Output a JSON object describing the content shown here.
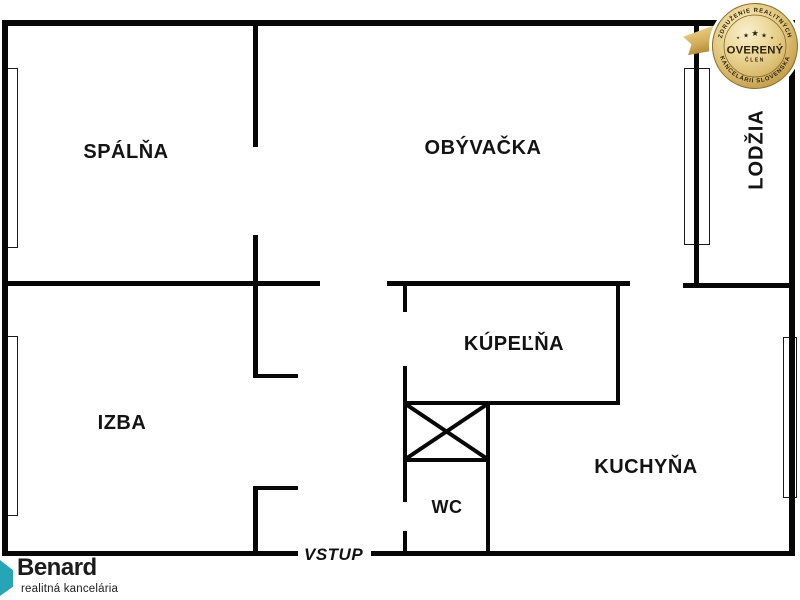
{
  "plan": {
    "background": "#ffffff",
    "wall_color": "#000000",
    "rooms": {
      "spalna": {
        "label": "SPÁLŇA"
      },
      "obyvacka": {
        "label": "OBÝVAČKA"
      },
      "lodzia": {
        "label": "LODŽIA"
      },
      "izba": {
        "label": "IZBA"
      },
      "kupelna": {
        "label": "KÚPEĽŇA"
      },
      "wc": {
        "label": "WC"
      },
      "kuchyna": {
        "label": "KUCHYŇA"
      }
    },
    "entrance_label": "VSTUP"
  },
  "badge": {
    "arc_top": "ZDRUŽENIE REALITNÝCH",
    "arc_bottom": "KANCELÁRIÍ SLOVENSKA",
    "title": "OVERENÝ",
    "subtitle": "ČLEN",
    "stars": {
      "s1": "★",
      "s2": "★",
      "s3": "★",
      "s4": "★",
      "s5": "★"
    },
    "colors": {
      "gold_light": "#f6ecc6",
      "gold": "#d9bc72",
      "gold_dark": "#a8842f",
      "text": "#2a1f08"
    }
  },
  "logo": {
    "name": "Benard",
    "tagline": "realitná kancelária",
    "accent_color": "#25a5b5"
  }
}
